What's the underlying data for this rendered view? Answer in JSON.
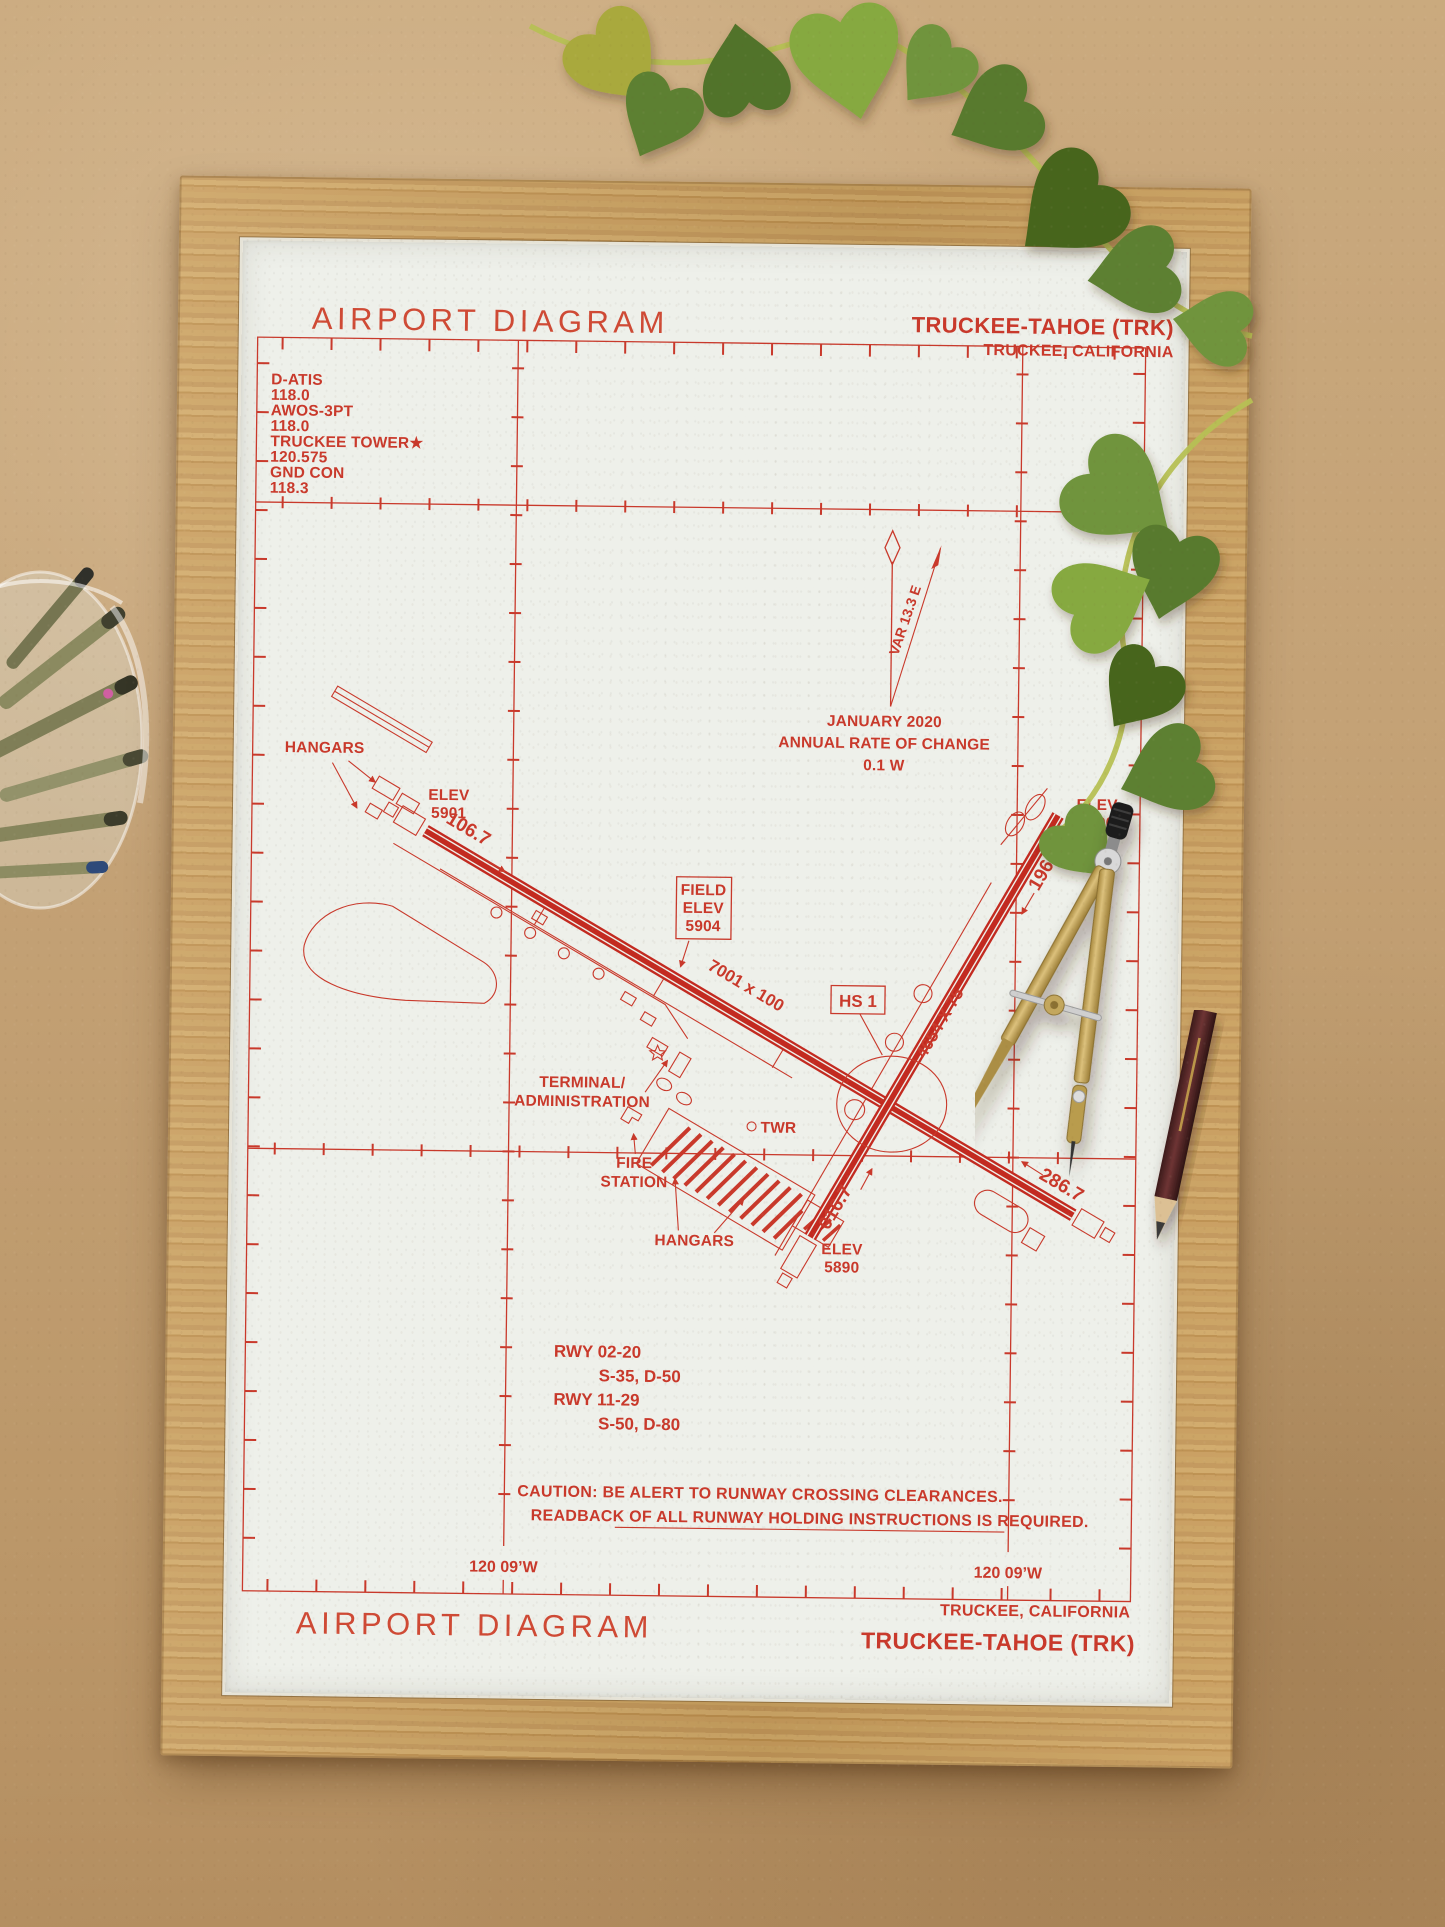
{
  "scene": {
    "background_color": "#c2a076",
    "frame_wood_color": "#c79a58",
    "paper_color": "#eef0ea",
    "ink_color": "#c9392b",
    "leaf_green": "#6f943c",
    "objects": [
      "oak-frame",
      "philodendron-vine",
      "glass-jar-with-pens",
      "drafting-compass",
      "wood-pencil"
    ]
  },
  "chart": {
    "header": {
      "title": "AIRPORT DIAGRAM",
      "airport": "TRUCKEE-TAHOE (TRK)",
      "city": "TRUCKEE, CALIFORNIA"
    },
    "comm_box": [
      "D-ATIS",
      "118.0",
      "AWOS-3PT",
      "118.0",
      "TRUCKEE TOWER★",
      "120.575",
      "GND CON",
      "118.3"
    ],
    "graticule": {
      "lat_label": "39 19’N",
      "lon_label_left": "120 09’W",
      "lon_label_right": "120 09’W"
    },
    "magnetic": {
      "variation": "VAR 13.3 E",
      "date": "JANUARY 2020",
      "rate_line": "ANNUAL RATE OF CHANGE",
      "rate_value": "0.1  W"
    },
    "field_elev": [
      "FIELD",
      "ELEV",
      "5904"
    ],
    "hot_spot_label": "HS 1",
    "runway_labels": {
      "dim_11_29": "7001 x 100",
      "dim_02_20": "4654 X 75",
      "hdg_11": "106.7",
      "hdg_29": "286.7",
      "hdg_02": "016.7",
      "hdg_20": "196.7",
      "elev_11": [
        "ELEV",
        "5901"
      ],
      "elev_20": [
        "ELEV",
        "5890"
      ],
      "elev_02": [
        "ELEV",
        "5890"
      ]
    },
    "facilities": {
      "hangars_west": "HANGARS",
      "hangars_south": "HANGARS",
      "terminal": [
        "TERMINAL/",
        "ADMINISTRATION"
      ],
      "fire_station": [
        "FIRE",
        "STATION"
      ],
      "tower": "TWR"
    },
    "runway_data": [
      "RWY 02-20",
      "S-35, D-50",
      "RWY 11-29",
      "S-50, D-80"
    ],
    "caution": [
      "CAUTION: BE ALERT TO RUNWAY CROSSING CLEARANCES.",
      "READBACK OF ALL RUNWAY HOLDING INSTRUCTIONS IS REQUIRED."
    ],
    "footer": {
      "title": "AIRPORT DIAGRAM",
      "city": "TRUCKEE, CALIFORNIA",
      "airport": "TRUCKEE-TAHOE (TRK)"
    }
  }
}
